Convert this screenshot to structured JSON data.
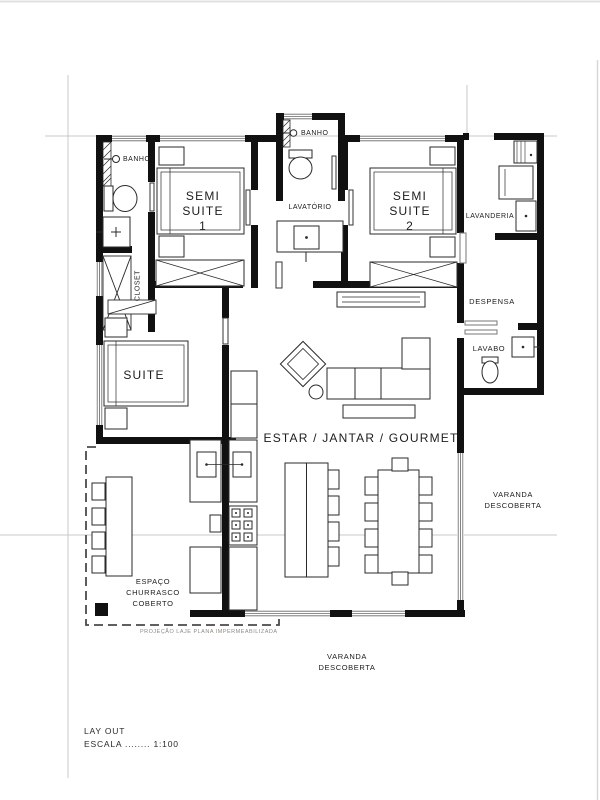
{
  "plan": {
    "rooms": {
      "banho_top_left": "BANHO",
      "semi_suite_1": "SEMI\nSUITE\n1",
      "banho_middle": "BANHO",
      "semi_suite_2": "SEMI\nSUITE\n2",
      "lavatorio": "LAVATÓRIO",
      "lavanderia": "LAVANDERIA",
      "despensa": "DESPENSA",
      "lavabo": "LAVABO",
      "closet": "CLOSET",
      "suite": "SUITE",
      "estar_jantar_gourmet": "ESTAR / JANTAR / GOURMET",
      "varanda_direita": "VARANDA\nDESCOBERTA",
      "espaco_churrasco": "ESPAÇO\nCHURRASCO\nCOBERTO",
      "varanda_inferior": "VARANDA\nDESCOBERTA"
    },
    "annotations": {
      "projecao_laje": "PROJEÇÃO LAJE PLANA IMPERMEABILIZADA"
    },
    "title_block": {
      "drawing_title": "LAY OUT",
      "scale": "ESCALA ........ 1:100"
    },
    "colors": {
      "ink": "#111111",
      "furniture_line": "#2a2a2a",
      "grid_line": "#c9c9c9",
      "dashed_line": "#4a4a4a"
    }
  }
}
